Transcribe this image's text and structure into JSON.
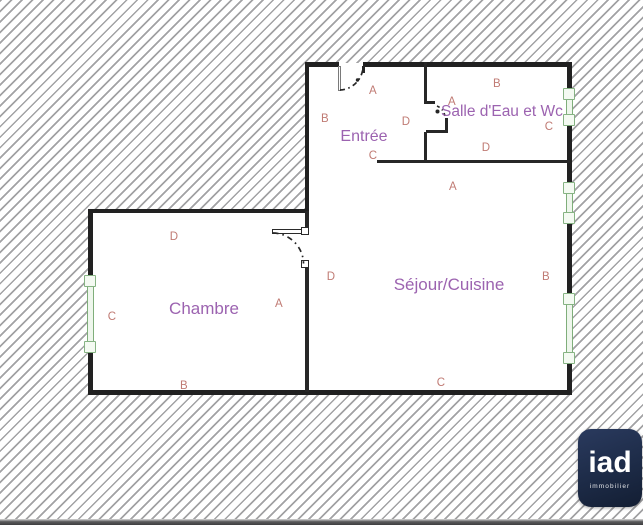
{
  "plan_title": "apartment-floor-plan",
  "rooms": {
    "entree": {
      "name": "Entrée"
    },
    "salle_eau": {
      "name": "Salle d'Eau et Wc"
    },
    "sejour": {
      "name": "Séjour/Cuisine"
    },
    "chambre": {
      "name": "Chambre"
    }
  },
  "wall_letters": {
    "entree": {
      "top": "A",
      "left": "B",
      "right": "D",
      "bottom": "C"
    },
    "salle_eau": {
      "top": "B",
      "center": "A",
      "right": "C",
      "bottom": "D"
    },
    "sejour": {
      "top": "A",
      "left": "D",
      "right": "B",
      "bottom": "C"
    },
    "chambre": {
      "top": "D",
      "left": "C",
      "right": "A",
      "bottom": "B"
    }
  },
  "logo": {
    "brand": "iad",
    "tagline": "immobilier"
  },
  "colors": {
    "room_label": "#9c63b0",
    "wall_letter": "#c07b74",
    "wall": "#212121",
    "window_green": "#7fae7a",
    "hatch_line": "#a2a2a4",
    "logo_background": "#1d2b47",
    "logo_text": "#ffffff"
  }
}
